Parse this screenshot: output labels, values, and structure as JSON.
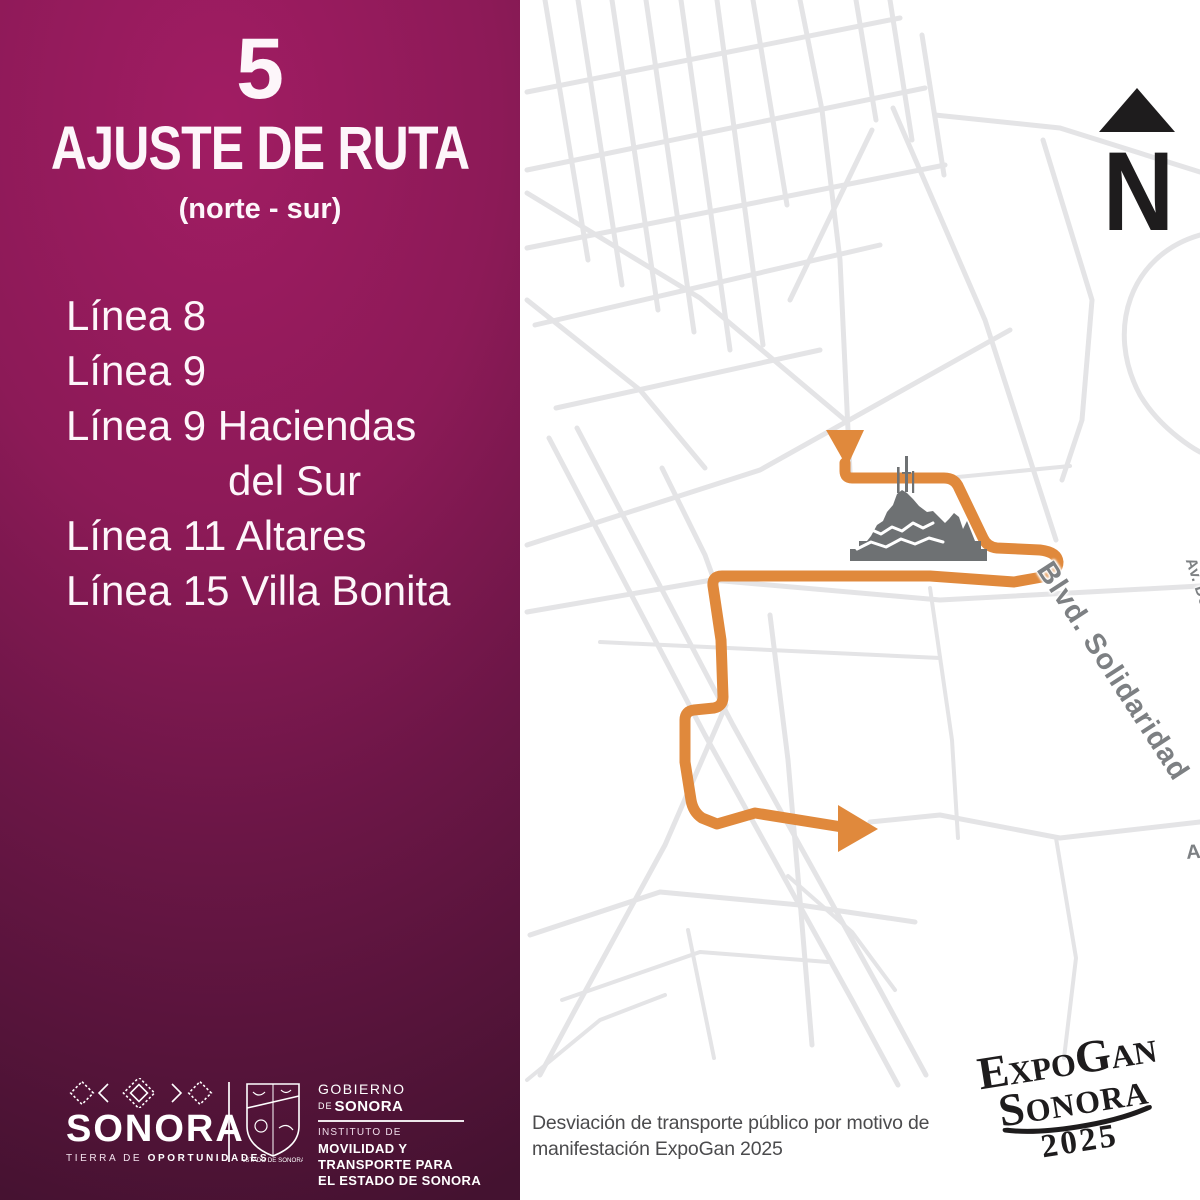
{
  "colors": {
    "panel_top": "#A11C63",
    "panel_mid": "#8C1A57",
    "panel_dark": "#441230",
    "panel_edge": "#4A1130",
    "route_orange": "#E0893C",
    "road_gray": "#E4E4E6",
    "label_gray": "#7D8083",
    "hill_gray": "#6E7173",
    "ink": "#1E1C1D",
    "caption_gray": "#4B4B4D"
  },
  "panel": {
    "number": "5",
    "title": "AJUSTE DE RUTA",
    "direction": "(norte - sur)",
    "lines": [
      "Línea 8",
      "Línea 9",
      "Línea 9 Haciendas",
      "del Sur",
      "Línea 11 Altares",
      "Línea 15 Villa Bonita"
    ]
  },
  "footer": {
    "brand_name": "SONORA",
    "tagline_light": "TIERRA DE",
    "tagline_bold": "OPORTUNIDADES",
    "shield_caption": "ESTADO DE SONORA",
    "gov_line1": "GOBIERNO",
    "gov_line2_small": "DE",
    "gov_line2": "SONORA",
    "inst_line1": "INSTITUTO DE",
    "inst_line2": "MOVILIDAD Y",
    "inst_line3": "TRANSPORTE PARA",
    "inst_line4": "EL ESTADO DE SONORA"
  },
  "map": {
    "north_label": "N",
    "streets": {
      "yanez": "Calle Gral. José María Yáñez",
      "reeleccion": "Av. No Reeleccion",
      "ernesto": "Av. Prof. Ernesto López Riesgo",
      "serna": "Blvd. Francisco Serna",
      "reforma": "Av. De La Reforma",
      "solidaridad": "Blvd. Solidaridad",
      "ojeda": "Av. Manuel Ojeda"
    }
  },
  "caption": {
    "line1": "Desviación de transporte público por motivo de",
    "line2": "manifestación ExpoGan 2025"
  },
  "expogan": {
    "line1": "ExpoGan",
    "line2": "Sonora",
    "line3": "2025"
  }
}
